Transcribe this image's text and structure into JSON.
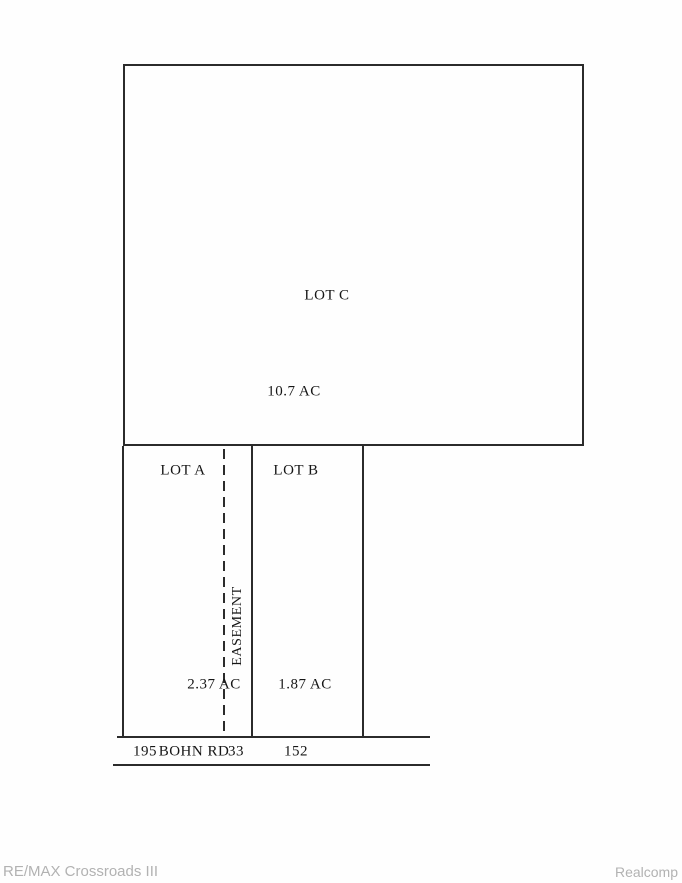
{
  "plat": {
    "lot_c": {
      "label": "LOT C",
      "area": "10.7 AC"
    },
    "lot_a": {
      "label": "LOT A",
      "area": "2.37 AC"
    },
    "lot_b": {
      "label": "LOT B",
      "area": "1.87 AC"
    },
    "easement": {
      "label": "EASEMENT",
      "width_ft": "33"
    },
    "road": {
      "name": "BOHN RD"
    },
    "frontages": {
      "lot_a_ft": "195",
      "lot_b_ft": "152"
    }
  },
  "footer": {
    "brokerage": "RE/MAX Crossroads III",
    "source": "Realcomp"
  },
  "colors": {
    "line": "#2b2b2b",
    "label_text": "#161616",
    "footer_text": "#b2b2b2",
    "background": "#fefefe"
  }
}
